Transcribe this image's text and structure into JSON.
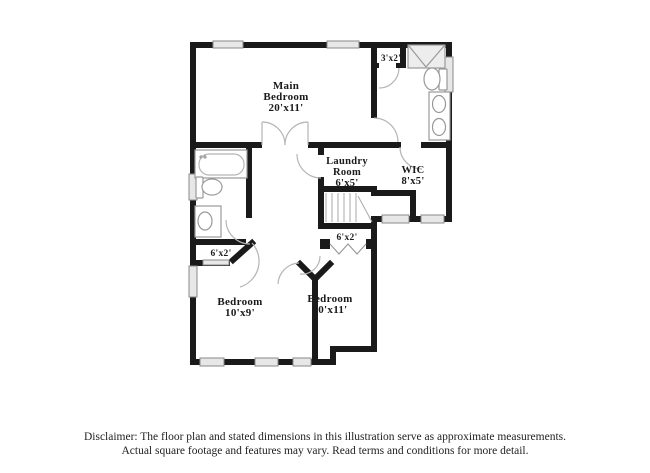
{
  "floor_plan": {
    "rooms": [
      {
        "id": "main-bedroom",
        "lines": [
          "Main",
          "Bedroom",
          "20'x11'"
        ]
      },
      {
        "id": "closet-3x2",
        "lines": [
          "3'x2'"
        ]
      },
      {
        "id": "laundry-room",
        "lines": [
          "Laundry",
          "Room",
          "6'x5'"
        ]
      },
      {
        "id": "wic",
        "lines": [
          "WIC",
          "8'x5'"
        ]
      },
      {
        "id": "closet-left",
        "lines": [
          "6'x2'"
        ]
      },
      {
        "id": "closet-middle",
        "lines": [
          "6'x2'"
        ]
      },
      {
        "id": "bedroom-left",
        "lines": [
          "Bedroom",
          "10'x9'"
        ]
      },
      {
        "id": "bedroom-right",
        "lines": [
          "Bedroom",
          "10'x11'"
        ]
      }
    ],
    "colors": {
      "wall": "#1a1a1a",
      "fixture_outline": "#999999",
      "door_arc": "#b5b5b5",
      "window_fill": "#e7e7e7",
      "window_stroke": "#8a8a8a",
      "text": "#1a1a1a"
    }
  },
  "disclaimer": {
    "line1": "Disclaimer: The floor plan and stated dimensions in this illustration serve as approximate measurements.",
    "line2": "Actual square footage and features may vary. Read terms and conditions for more detail."
  }
}
